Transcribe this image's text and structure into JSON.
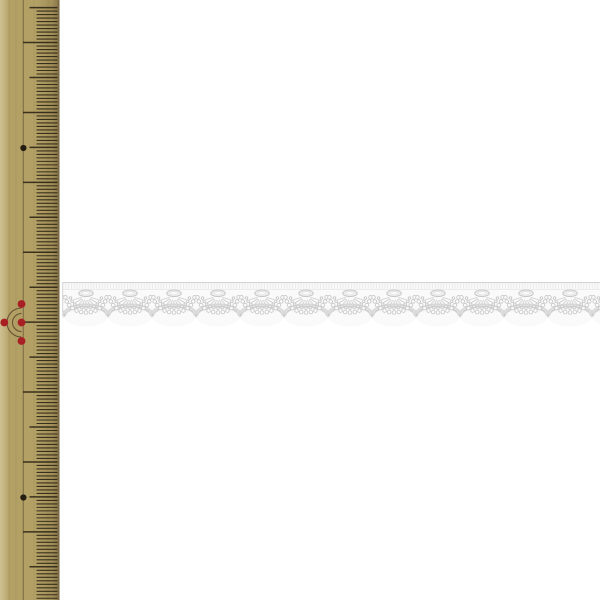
{
  "scene": {
    "label": "white scalloped lace trim photographed beside a wooden ruler",
    "background_color": "#ffffff",
    "width_px": 600,
    "height_px": 600
  },
  "ruler": {
    "label": "wooden metric ruler, vertical, cropped at left edge of photo",
    "wood_color": "#b2a065",
    "wood_highlight_color": "#cfc191",
    "wood_shade_color": "#a28f58",
    "edge_color": "#6f5f3a",
    "tick_color": "#2f2717",
    "guide_line_color": "#44371f",
    "body_width_px": 59.5,
    "tick_right_x": 57.5,
    "guide_line_x": 23.2,
    "first_tick_y": 7.6,
    "mm_spacing_px": 3.495,
    "tick_len_mm": 21,
    "tick_len_cm_medium": 28,
    "tick_len_cm_long": 34.5,
    "black_dots": {
      "color": "#241d12",
      "radius": 3.1,
      "x": 23.4,
      "ys": [
        148,
        497.5
      ]
    },
    "center_mark": {
      "x": 21.5,
      "y": 322.5,
      "dot_color": "#a81f24",
      "dot_radius": 3.9,
      "satellite_offset": 18.5,
      "left_dot_x": 4.3,
      "arc_radii": [
        9,
        14.5
      ],
      "arc_color": "#4a3b20"
    }
  },
  "lace": {
    "label": "white scalloped embroidered lace trim, horizontal",
    "base_color": "#fafafa",
    "detail_color": "#d4d4d4",
    "mid_detail_color": "#cbcbcb",
    "edge_color": "#c3c3c3",
    "highlight_color": "#e6e6e6",
    "start_x": 62,
    "end_x": 600,
    "top_y": 282,
    "band_bottom_y": 290,
    "eyelet_y": 293.3,
    "notch_y": 316,
    "bottom_y": 326.5,
    "scallop_width": 44,
    "first_notch_x": 20,
    "scallop_count": 14,
    "features": [
      "picot top band",
      "oval eyelet per scallop",
      "radiating fan stitches",
      "arc of small holes",
      "arc of loop stitches",
      "scalloped satin border"
    ]
  }
}
